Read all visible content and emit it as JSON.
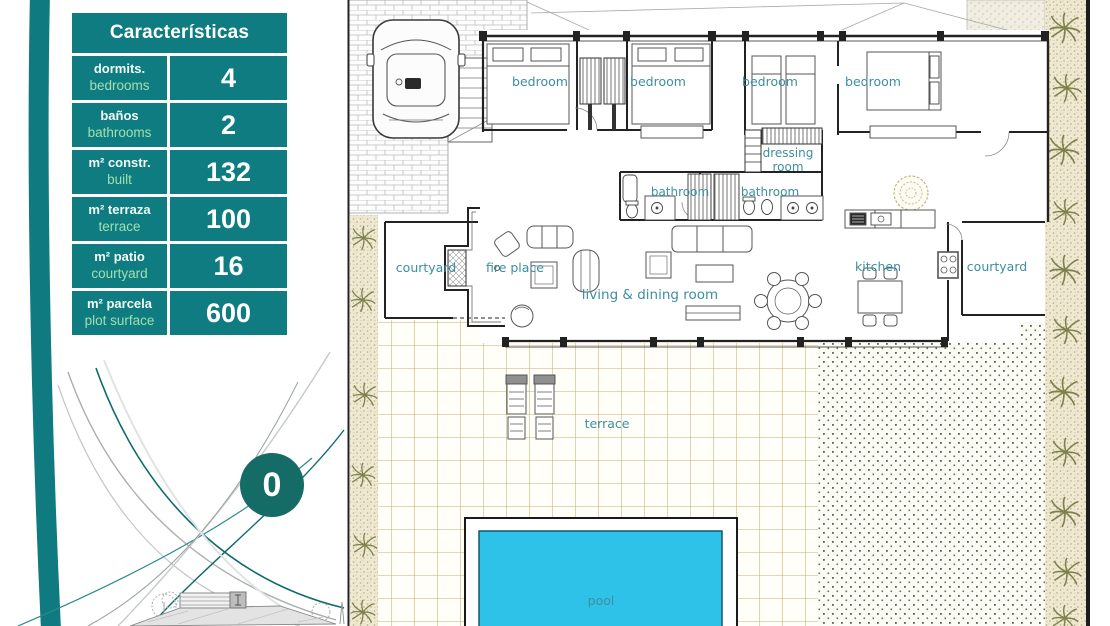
{
  "table": {
    "header": "Características",
    "rows": [
      {
        "es": "dormits.",
        "en": "bedrooms",
        "value": "4"
      },
      {
        "es": "baños",
        "en": "bathrooms",
        "value": "2"
      },
      {
        "es": "m² constr.",
        "en": "built",
        "value": "132"
      },
      {
        "es": "m² terraza",
        "en": "terrace",
        "value": "100"
      },
      {
        "es": "m² patio",
        "en": "courtyard",
        "value": "16"
      },
      {
        "es": "m² parcela",
        "en": "plot surface",
        "value": "600"
      }
    ]
  },
  "badge": {
    "value": "0"
  },
  "plan": {
    "labels": {
      "bedroom_1": "bedroom",
      "bedroom_2": "bedroom",
      "bedroom_3": "bedroom",
      "bedroom_4": "bedroom",
      "dressing_line1": "dressing",
      "dressing_line2": "room",
      "bathroom_1": "bathroom",
      "bathroom_2": "bathroom",
      "courtyard_left": "courtyard",
      "courtyard_right": "courtyard",
      "fire_place": "fire place",
      "living_dining": "living & dining room",
      "kitchen": "kitchen",
      "terrace": "terrace",
      "pool": "pool"
    }
  },
  "colors": {
    "table_teal": "#0f7c81",
    "label_en_green": "#9fe0ae",
    "badge_teal": "#156b66",
    "room_label": "#3d8fa0",
    "pool_water": "#2fc2e8",
    "terrace_line": "#c9ad74"
  }
}
